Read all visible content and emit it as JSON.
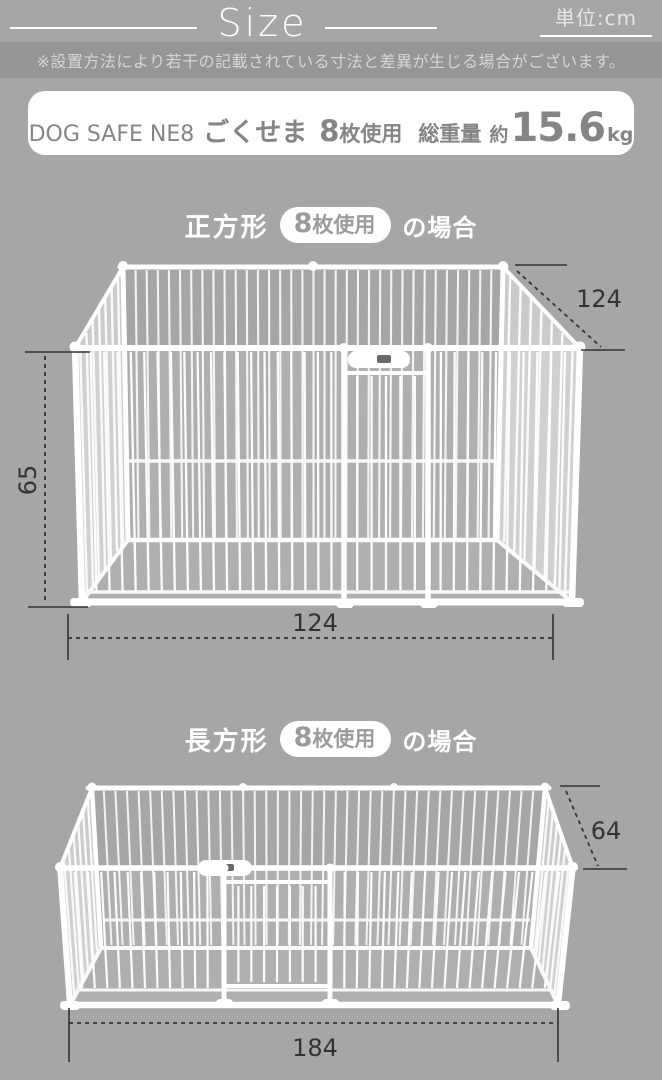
{
  "page": {
    "title": "Size",
    "unit_label": "単位:cm",
    "disclaimer": "※設置方法により若干の記載されている寸法と差異が生じる場合がございます。",
    "colors": {
      "background": "#a6a6a6",
      "banner": "#959595",
      "panel_white": "#ffffff",
      "product_text_gray": "#858585",
      "dimension_ink": "#333333"
    }
  },
  "product": {
    "model": "DOG SAFE NE8",
    "series_name": "ごくせま",
    "panel_count": "8",
    "panel_unit": "枚使用",
    "weight_label": "総重量",
    "weight_prefix": "約",
    "weight_value": "15.6",
    "weight_unit": "kg"
  },
  "sections": [
    {
      "shape_label": "正方形",
      "badge_count": "8",
      "badge_unit": "枚使用",
      "case_suffix": "の場合",
      "dimensions": {
        "depth_cm": "124",
        "height_cm": "65",
        "width_cm": "124"
      }
    },
    {
      "shape_label": "長方形",
      "badge_count": "8",
      "badge_unit": "枚使用",
      "case_suffix": "の場合",
      "dimensions": {
        "depth_cm": "64",
        "width_cm": "184"
      }
    }
  ]
}
